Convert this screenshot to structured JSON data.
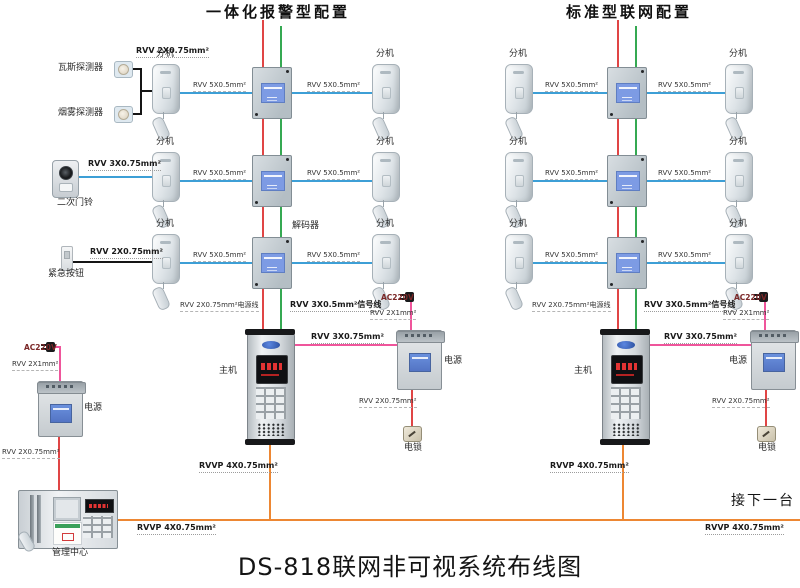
{
  "titles": {
    "left_section": "一体化报警型配置",
    "right_section": "标准型联网配置",
    "main": "DS-818联网非可视系统布线图",
    "next_unit": "接下一台"
  },
  "labels": {
    "extension": "分机",
    "decoder": "解码器",
    "host": "主机",
    "power_supply": "电源",
    "electric_lock": "电锁",
    "management_center": "管理中心",
    "gas_detector": "瓦斯探测器",
    "smoke_detector": "烟雾探测器",
    "second_doorbell": "二次门铃",
    "emergency_button": "紧急按钮",
    "ac220v": "AC220V"
  },
  "cables": {
    "rvv_2x075": "RVV 2X0.75mm²",
    "rvv_3x075": "RVV 3X0.75mm²",
    "rvv_5x05": "RVV 5X0.5mm²",
    "rvv_2x075_power_line": "RVV 2X0.75mm²电源线",
    "rvv_3x05_signal_line": "RVV 3X0.5mm²信号线",
    "rvv_2x1": "RVV 2X1mm²",
    "rvvp_4x075": "RVVP 4X0.75mm²"
  },
  "colors": {
    "signal_blue": "#3d9fd6",
    "power_red": "#e04545",
    "riser_green": "#35a952",
    "power_pink": "#ef559b",
    "bus_orange": "#ed8733",
    "wire_black": "#151515"
  }
}
